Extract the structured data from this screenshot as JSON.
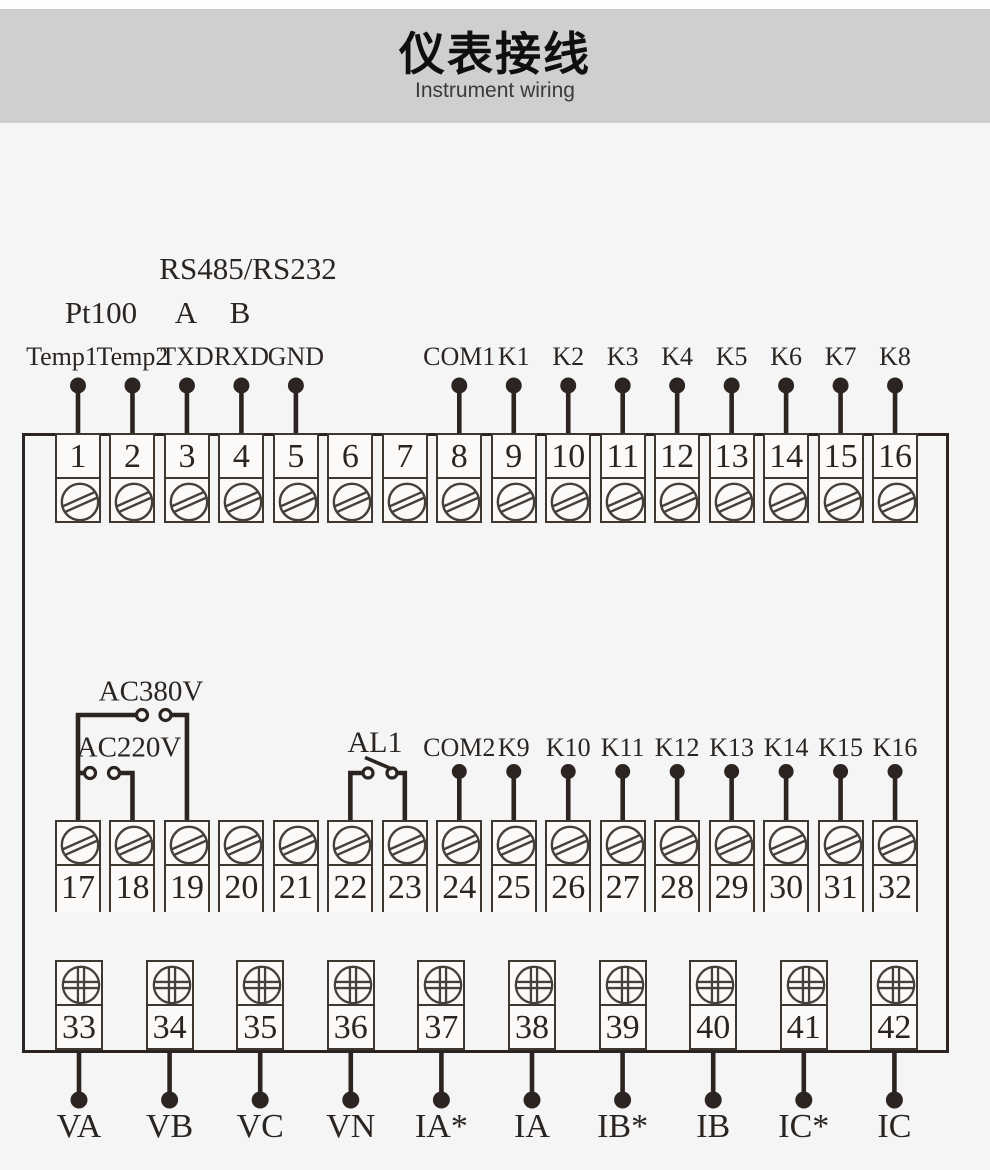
{
  "colors": {
    "page_bg": "#f6f5f5",
    "header_bg": "#d0ced0",
    "line": "#2b2420",
    "cell_border": "#3e3831",
    "screw_stroke": "#45403a",
    "text": "#2b2521"
  },
  "header": {
    "title": "仪表接线",
    "subtitle": "Instrument wiring"
  },
  "annotations": {
    "rs485": "RS485/RS232",
    "pt100": "Pt100",
    "a": "A",
    "b": "B"
  },
  "terminal_rows": [
    {
      "id": "top",
      "screw": "slot",
      "numbers": [
        "1",
        "2",
        "3",
        "4",
        "5",
        "6",
        "7",
        "8",
        "9",
        "10",
        "11",
        "12",
        "13",
        "14",
        "15",
        "16"
      ],
      "pins": [
        {
          "terminal": 1,
          "label": "Temp1",
          "dx": -16
        },
        {
          "terminal": 2,
          "label": "Temp2"
        },
        {
          "terminal": 3,
          "label": "TXD"
        },
        {
          "terminal": 4,
          "label": "RXD"
        },
        {
          "terminal": 5,
          "label": "GND"
        },
        {
          "terminal": 8,
          "label": "COM1"
        },
        {
          "terminal": 9,
          "label": "K1"
        },
        {
          "terminal": 10,
          "label": "K2"
        },
        {
          "terminal": 11,
          "label": "K3"
        },
        {
          "terminal": 12,
          "label": "K4"
        },
        {
          "terminal": 13,
          "label": "K5"
        },
        {
          "terminal": 14,
          "label": "K6"
        },
        {
          "terminal": 15,
          "label": "K7"
        },
        {
          "terminal": 16,
          "label": "K8"
        }
      ]
    },
    {
      "id": "middle",
      "screw": "slot",
      "numbers": [
        "17",
        "18",
        "19",
        "20",
        "21",
        "22",
        "23",
        "24",
        "25",
        "26",
        "27",
        "28",
        "29",
        "30",
        "31",
        "32"
      ],
      "pins": [
        {
          "terminal": 24,
          "label": "COM2"
        },
        {
          "terminal": 25,
          "label": "K9"
        },
        {
          "terminal": 26,
          "label": "K10"
        },
        {
          "terminal": 27,
          "label": "K11"
        },
        {
          "terminal": 28,
          "label": "K12"
        },
        {
          "terminal": 29,
          "label": "K13"
        },
        {
          "terminal": 30,
          "label": "K14"
        },
        {
          "terminal": 31,
          "label": "K15"
        },
        {
          "terminal": 32,
          "label": "K16"
        }
      ],
      "switches": [
        {
          "label": "AC380V",
          "from": 17,
          "to": 19
        },
        {
          "label": "AC220V",
          "from": 17,
          "to": 18
        },
        {
          "label": "AL1",
          "from": 22,
          "to": 23
        }
      ]
    },
    {
      "id": "bottom",
      "screw": "phillips",
      "numbers": [
        "33",
        "34",
        "35",
        "36",
        "37",
        "38",
        "39",
        "40",
        "41",
        "42"
      ],
      "pins": [
        {
          "terminal": 33,
          "label": "VA"
        },
        {
          "terminal": 34,
          "label": "VB"
        },
        {
          "terminal": 35,
          "label": "VC"
        },
        {
          "terminal": 36,
          "label": "VN"
        },
        {
          "terminal": 37,
          "label": "IA*"
        },
        {
          "terminal": 38,
          "label": "IA"
        },
        {
          "terminal": 39,
          "label": "IB*"
        },
        {
          "terminal": 40,
          "label": "IB"
        },
        {
          "terminal": 41,
          "label": "IC*"
        },
        {
          "terminal": 42,
          "label": "IC"
        }
      ]
    }
  ]
}
